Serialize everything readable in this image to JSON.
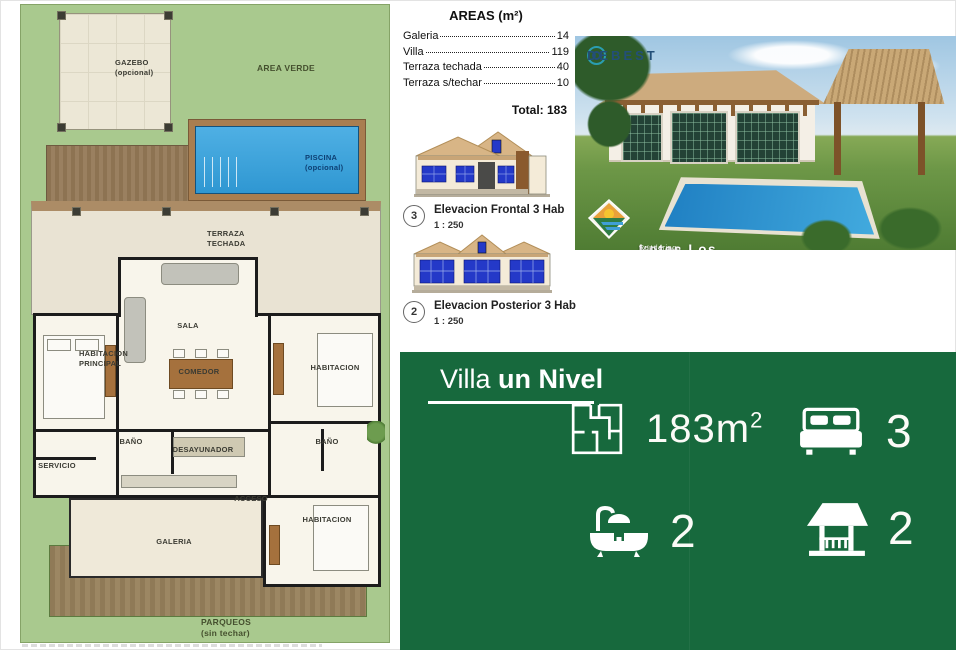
{
  "plan": {
    "labels": {
      "gazebo": "GAZEBO",
      "gazebo_sub": "(opcional)",
      "area_verde": "AREA VERDE",
      "piscina": "PISCINA",
      "piscina_sub": "(opcional)",
      "terraza_l1": "TERRAZA",
      "terraza_l2": "TECHADA",
      "sala": "SALA",
      "habitacion_principal_l1": "HABITACION",
      "habitacion_principal_l2": "PRINCIPAL",
      "comedor": "COMEDOR",
      "habitacion_right": "HABITACION",
      "bano_left": "BAÑO",
      "desayunador": "DESAYUNADOR",
      "bano_right": "BAÑO",
      "servicio": "SERVICIO",
      "acceso": "ACCESO",
      "galeria": "GALERIA",
      "habitacion_bottom": "HABITACION",
      "parqueos": "PARQUEOS",
      "parqueos_sub": "(sin techar)"
    }
  },
  "areas": {
    "title": "AREAS (m²)",
    "rows": [
      {
        "label": "Galeria",
        "value": "14"
      },
      {
        "label": "Villa",
        "value": "119"
      },
      {
        "label": "Terraza techada",
        "value": "40"
      },
      {
        "label": "Terraza s/techar",
        "value": "10"
      }
    ],
    "total": "Total: 183"
  },
  "elevations": [
    {
      "number": "3",
      "title": "Elevacion Frontal 3 Hab",
      "scale": "1 : 250"
    },
    {
      "number": "2",
      "title": "Elevacion Posterior 3 Hab",
      "scale": "1 : 250"
    }
  ],
  "photo": {
    "brand": "DEBEST",
    "caption_title": "Lotes Los Fundadores.",
    "caption_subtitle": "Villa un nivel. Tres (3) habitaciones.",
    "caption_fine": "Rendering no contractual sujeto a cambios.   Piscina y gazebo opcionales."
  },
  "panel": {
    "title_regular": "Villa ",
    "title_bold": "un Nivel",
    "stats": [
      {
        "icon": "floorplan-icon",
        "value": "183m",
        "sup": "2"
      },
      {
        "icon": "bed-icon",
        "value": "3"
      },
      {
        "icon": "bathtub-icon",
        "value": "2"
      },
      {
        "icon": "gazebo-icon",
        "value": "2"
      }
    ]
  },
  "colors": {
    "plan_green": "#a9c98e",
    "panel_green": "#17693d",
    "pool_blue": "#2f97d2",
    "roof_tan": "#d8b586",
    "window_blue": "#2439c8"
  }
}
